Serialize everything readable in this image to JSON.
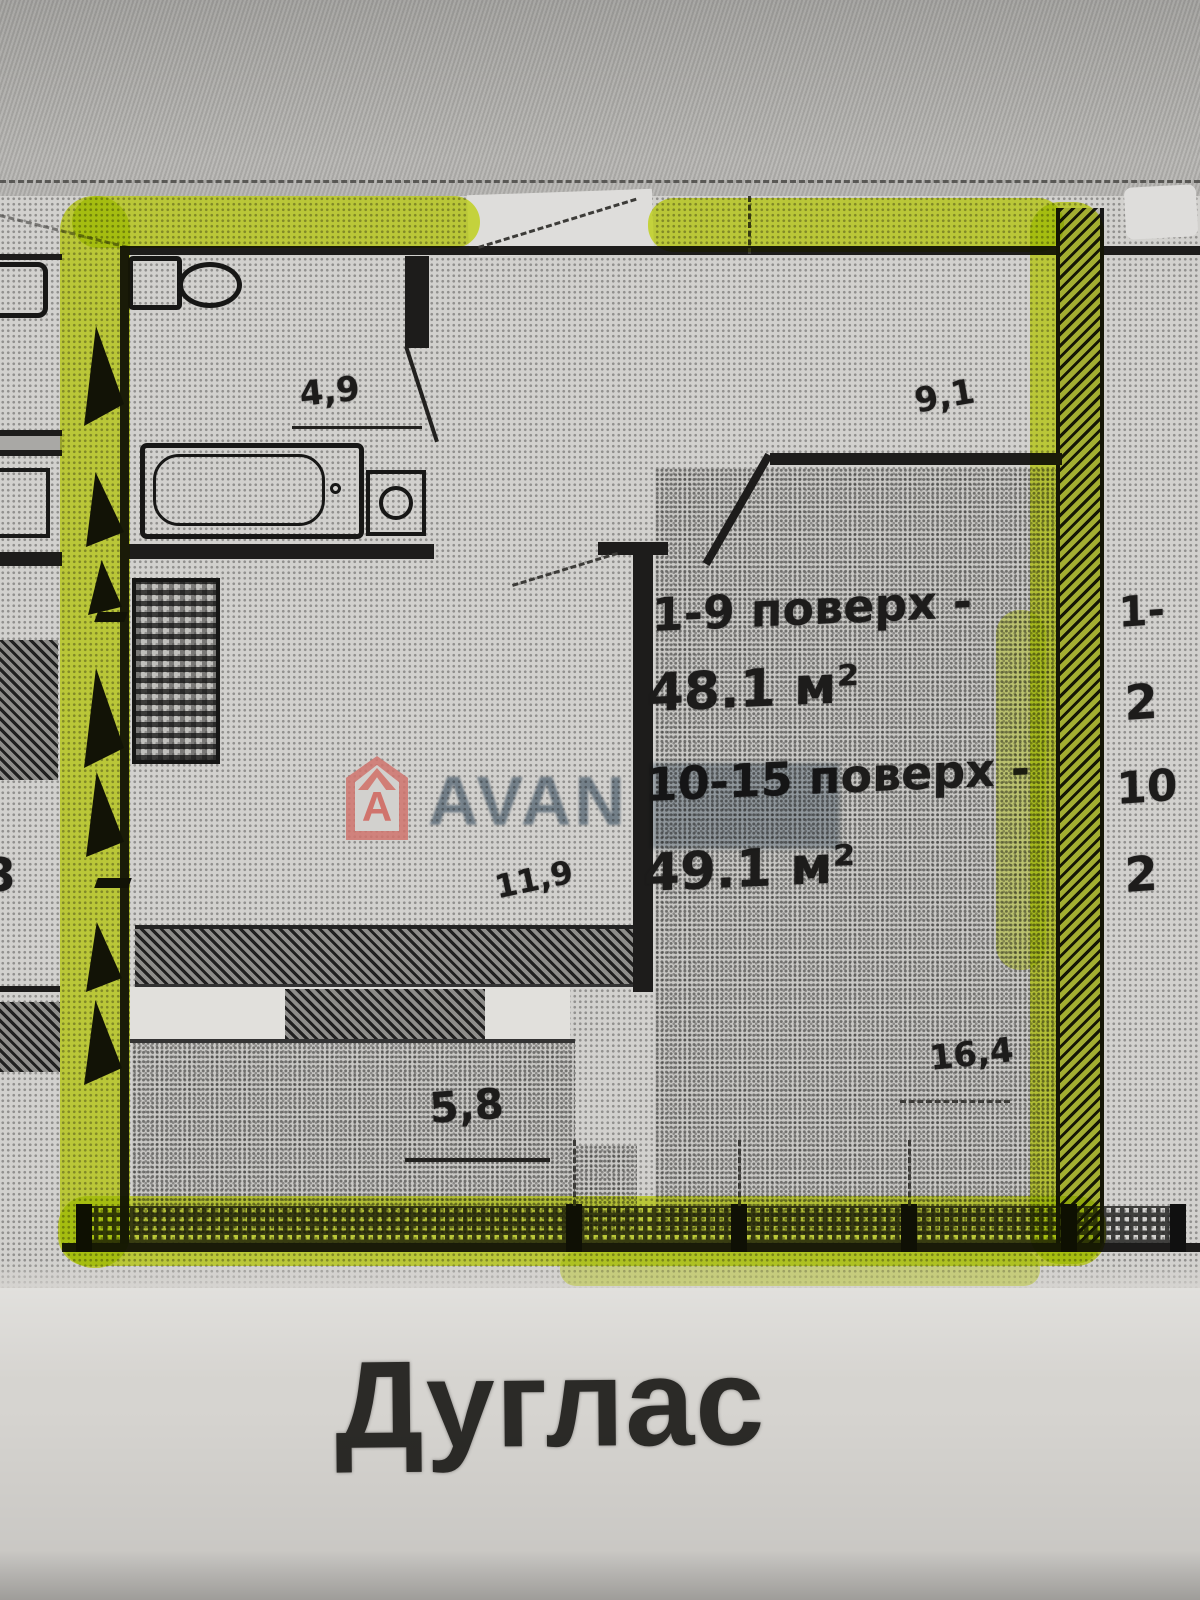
{
  "floor_plan": {
    "building_name": "Дуглас",
    "unit_info": {
      "floors_low_label": "1-9 поверх -",
      "floors_low_area": "48.1 м²",
      "floors_high_label": "10-15 поверх -",
      "floors_high_area": "49.1 м²"
    },
    "dimensions": {
      "bathroom_width": "4,9",
      "bedroom_top": "9,1",
      "hall": "11,9",
      "living_bottom": "5,8",
      "bedroom_bottom": "16,4"
    },
    "adjacent_unit_partial": {
      "line1": "1-",
      "line2": "2",
      "line3": "10",
      "line4": "2"
    },
    "left_edge_partial": "3",
    "watermark": {
      "brand_text": "AVAN",
      "logo_letter": "A"
    },
    "colors": {
      "highlight": "#e0f235",
      "watermark_text": "#6e8294",
      "logo_pink": "#d0746d"
    }
  }
}
